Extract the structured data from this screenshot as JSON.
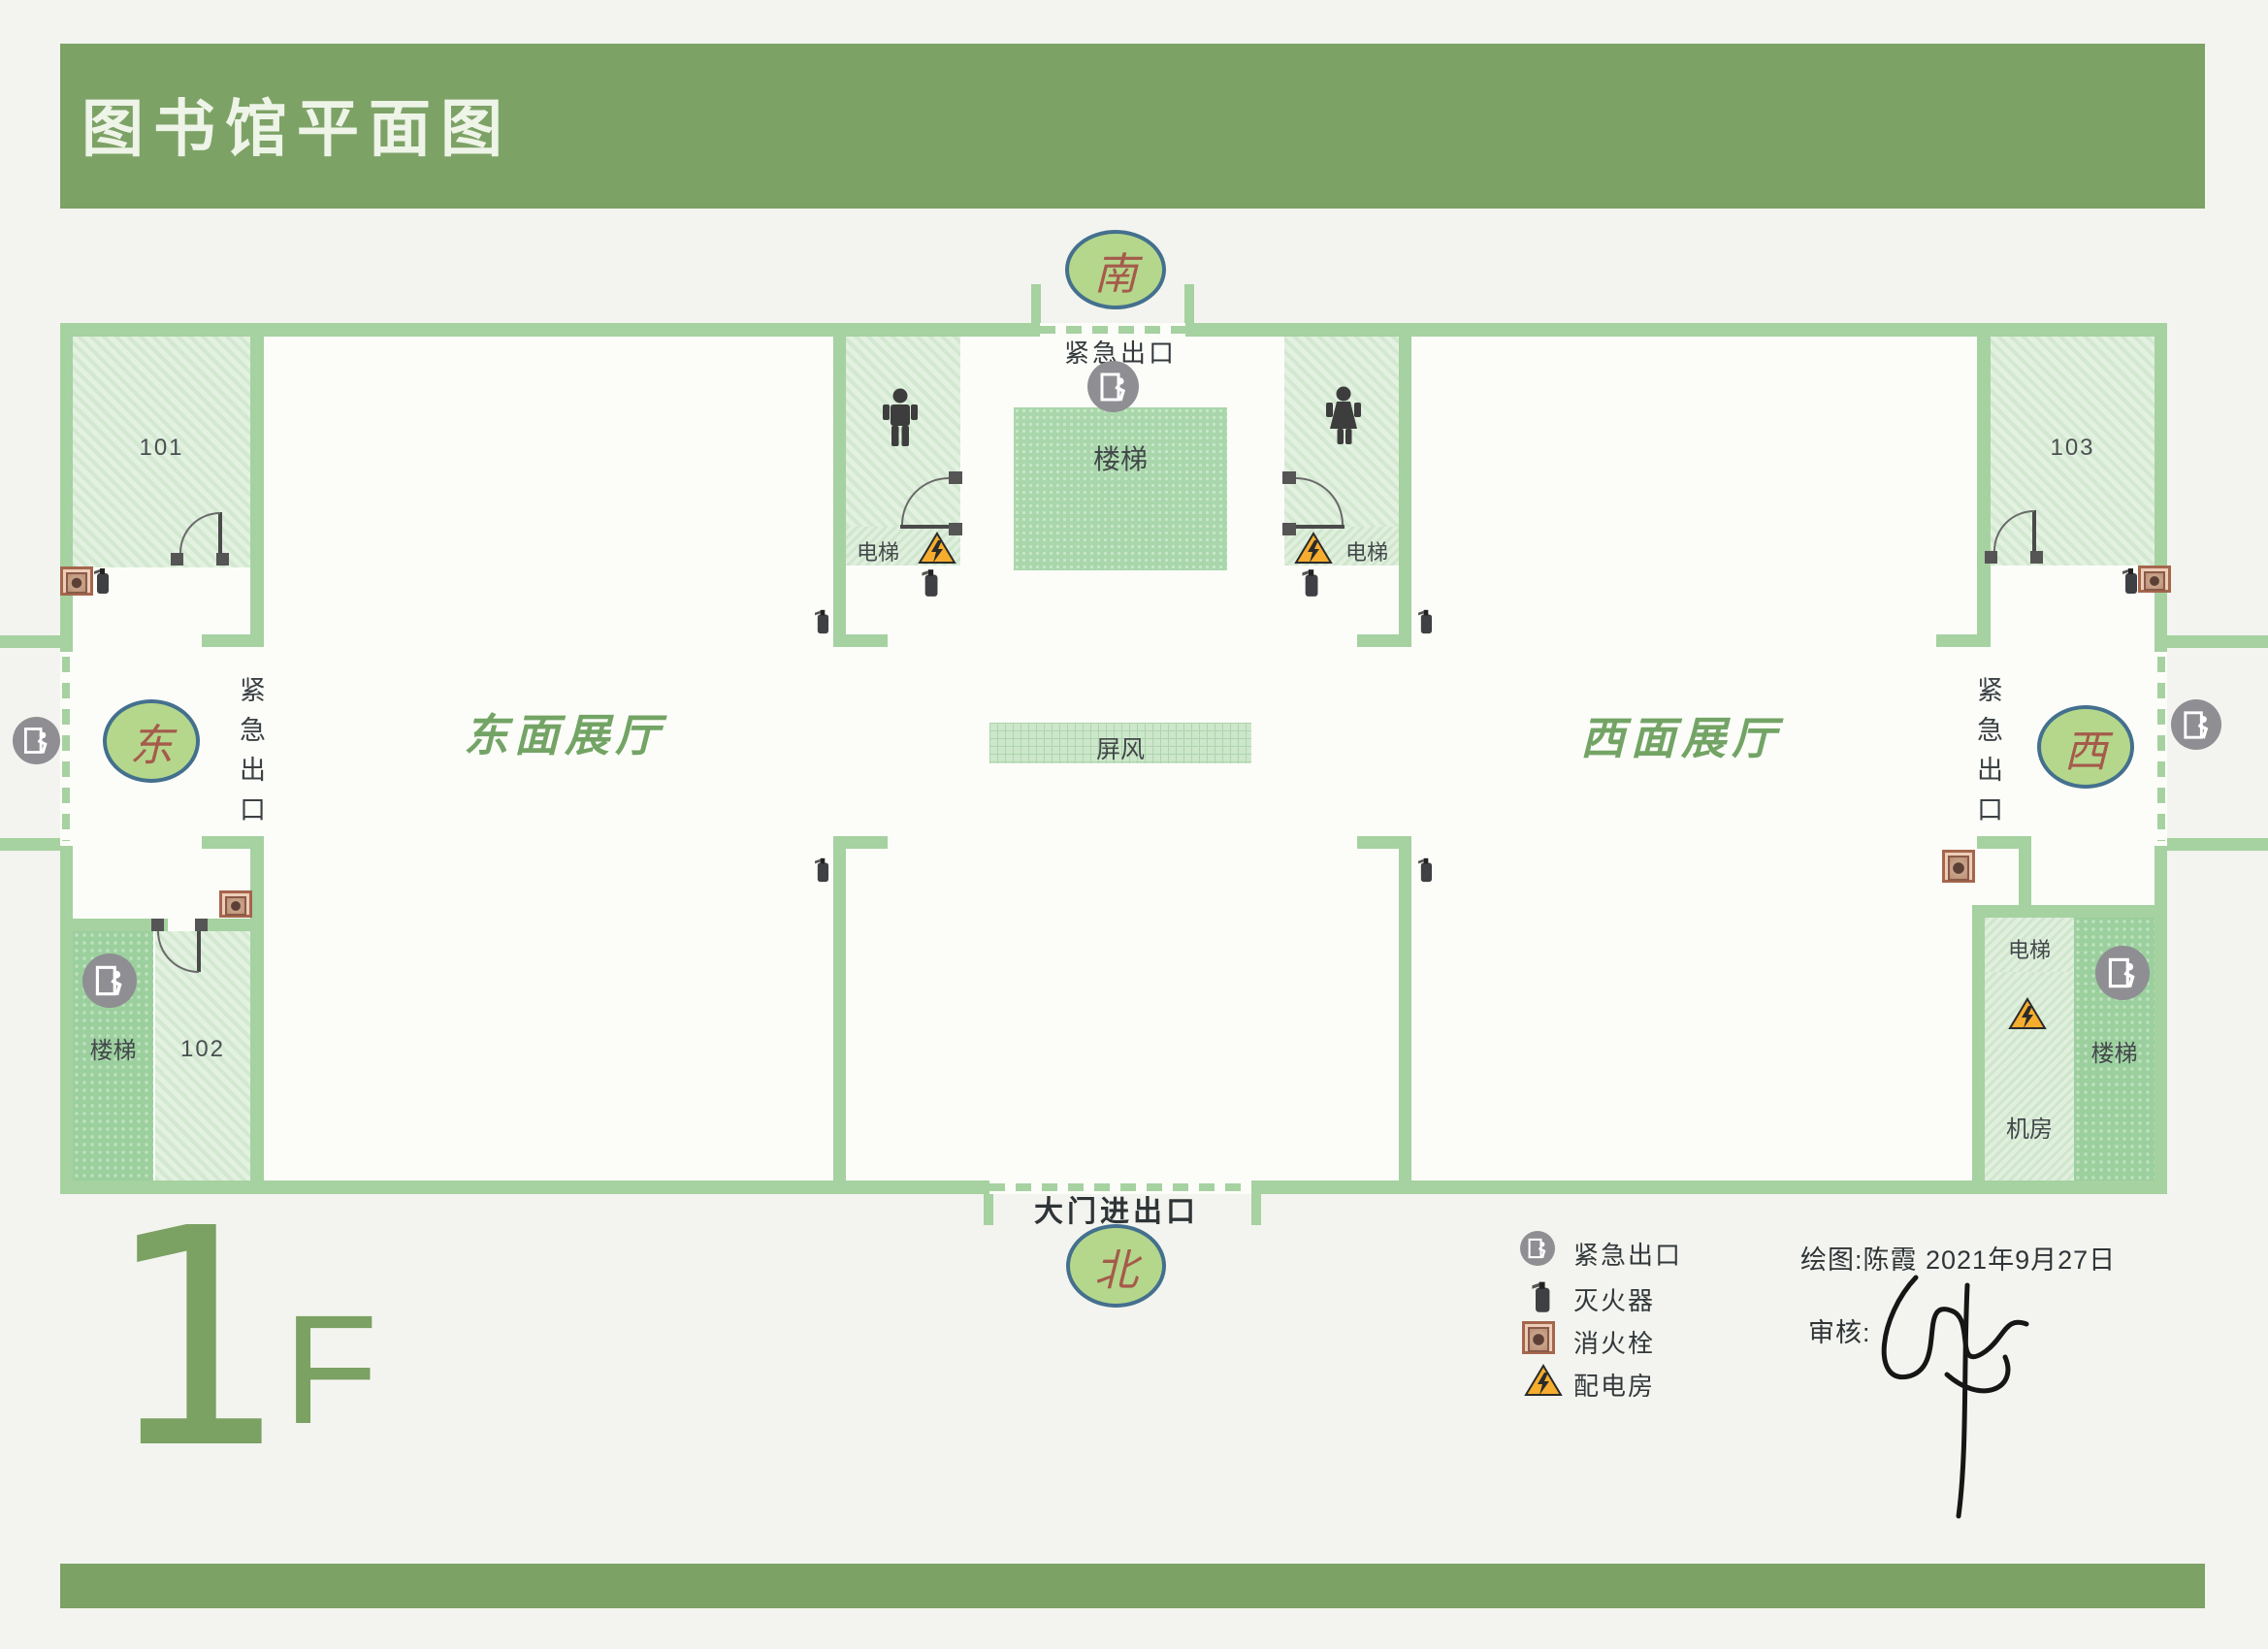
{
  "title": "图书馆平面图",
  "floor": {
    "number": "1",
    "suffix": "F"
  },
  "compass": {
    "south": "南",
    "north": "北",
    "east": "东",
    "west": "西"
  },
  "emergency_exit_label": "紧急出口",
  "entrance_label": "大门进出口",
  "halls": {
    "east": "东面展厅",
    "west": "西面展厅"
  },
  "rooms": {
    "r101": "101",
    "r102": "102",
    "r103": "103",
    "stairs": "楼梯",
    "elevator": "电梯",
    "machine_room": "机房",
    "screen": "屏风"
  },
  "legend": {
    "items": [
      {
        "icon": "exit-icon",
        "label": "紧急出口"
      },
      {
        "icon": "fire-extinguisher-icon",
        "label": "灭火器"
      },
      {
        "icon": "fire-hydrant-icon",
        "label": "消火栓"
      },
      {
        "icon": "power-room-icon",
        "label": "配电房"
      }
    ]
  },
  "credits": {
    "drawn_by": "绘图:陈霞  2021年9月27日",
    "reviewed_by": "审核:"
  },
  "colors": {
    "banner_green": "#7da266",
    "wall_green": "#a6d1a0",
    "compass_fill": "#b5d78c",
    "compass_border": "#44708e",
    "compass_text": "#a55b4b",
    "hall_label_green": "#73a465",
    "warning_orange": "#f6ad2e",
    "exit_gray": "#8e8e93"
  }
}
